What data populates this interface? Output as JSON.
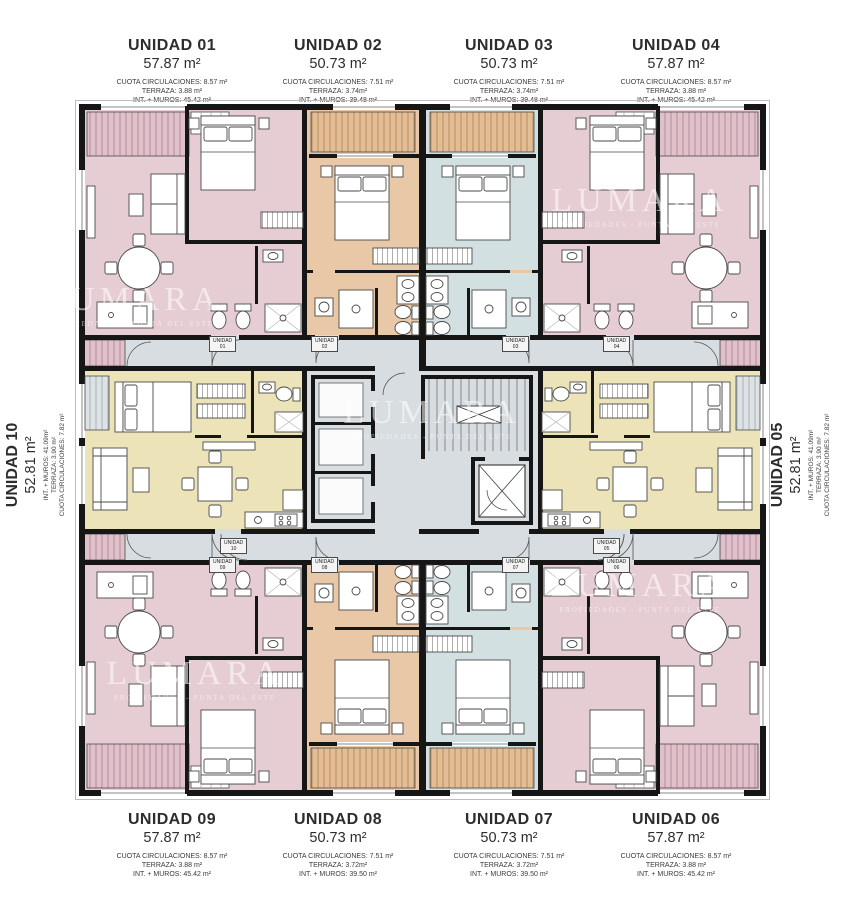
{
  "brand_watermark": {
    "name": "LUMARA",
    "tagline": "PROPIEDADES - PUNTA DEL ESTE"
  },
  "colors": {
    "wall": "#161616",
    "unit_corner_pink": "#e6ccd3",
    "unit_orange": "#e9c8a7",
    "unit_blue": "#d2e0e2",
    "unit_yellow": "#ece3b9",
    "circulation_gray": "#d7dde0"
  },
  "units": [
    {
      "id": "01",
      "title": "UNIDAD 01",
      "area": "57.87 m²",
      "circulaciones": "CUOTA CIRCULACIONES: 8.57 m²",
      "terraza": "TERRAZA: 3.88 m²",
      "interior": "INT. + MUROS: 45.42 m²"
    },
    {
      "id": "02",
      "title": "UNIDAD 02",
      "area": "50.73 m²",
      "circulaciones": "CUOTA CIRCULACIONES: 7.51 m²",
      "terraza": "TERRAZA: 3.74m²",
      "interior": "INT. + MUROS: 39.48 m²"
    },
    {
      "id": "03",
      "title": "UNIDAD 03",
      "area": "50.73 m²",
      "circulaciones": "CUOTA CIRCULACIONES: 7.51 m²",
      "terraza": "TERRAZA: 3.74m²",
      "interior": "INT. + MUROS: 39.48 m²"
    },
    {
      "id": "04",
      "title": "UNIDAD 04",
      "area": "57.87 m²",
      "circulaciones": "CUOTA CIRCULACIONES: 8.57 m²",
      "terraza": "TERRAZA: 3.88 m²",
      "interior": "INT. + MUROS: 45.42 m²"
    },
    {
      "id": "05",
      "title": "UNIDAD 05",
      "area": "52.81 m²",
      "circulaciones": "CUOTA CIRCULACIONES: 7.82 m²",
      "terraza": "TERRAZA: 3.90 m²",
      "interior": "INT. + MUROS: 41.09m²"
    },
    {
      "id": "06",
      "title": "UNIDAD 06",
      "area": "57.87 m²",
      "circulaciones": "CUOTA CIRCULACIONES: 8.57 m²",
      "terraza": "TERRAZA: 3.88 m²",
      "interior": "INT. + MUROS: 45.42 m²"
    },
    {
      "id": "07",
      "title": "UNIDAD 07",
      "area": "50.73 m²",
      "circulaciones": "CUOTA CIRCULACIONES: 7.51 m²",
      "terraza": "TERRAZA: 3.72m²",
      "interior": "INT. + MUROS: 39.50 m²"
    },
    {
      "id": "08",
      "title": "UNIDAD 08",
      "area": "50.73 m²",
      "circulaciones": "CUOTA CIRCULACIONES: 7.51 m²",
      "terraza": "TERRAZA: 3.72m²",
      "interior": "INT. + MUROS: 39.50 m²"
    },
    {
      "id": "09",
      "title": "UNIDAD 09",
      "area": "57.87 m²",
      "circulaciones": "CUOTA CIRCULACIONES: 8.57 m²",
      "terraza": "TERRAZA: 3.88 m²",
      "interior": "INT. + MUROS: 45.42 m²"
    },
    {
      "id": "10",
      "title": "UNIDAD 10",
      "area": "52.81 m²",
      "circulaciones": "CUOTA CIRCULACIONES: 7.82 m²",
      "terraza": "TERRAZA: 3.90 m²",
      "interior": "INT. + MUROS: 41.09m²"
    }
  ],
  "plan_tags": [
    {
      "line1": "UNIDAD",
      "line2": "01"
    },
    {
      "line1": "UNIDAD",
      "line2": "02"
    },
    {
      "line1": "UNIDAD",
      "line2": "03"
    },
    {
      "line1": "UNIDAD",
      "line2": "04"
    },
    {
      "line1": "UNIDAD",
      "line2": "05"
    },
    {
      "line1": "UNIDAD",
      "line2": "06"
    },
    {
      "line1": "UNIDAD",
      "line2": "07"
    },
    {
      "line1": "UNIDAD",
      "line2": "08"
    },
    {
      "line1": "UNIDAD",
      "line2": "09"
    },
    {
      "line1": "UNIDAD",
      "line2": "10"
    }
  ]
}
